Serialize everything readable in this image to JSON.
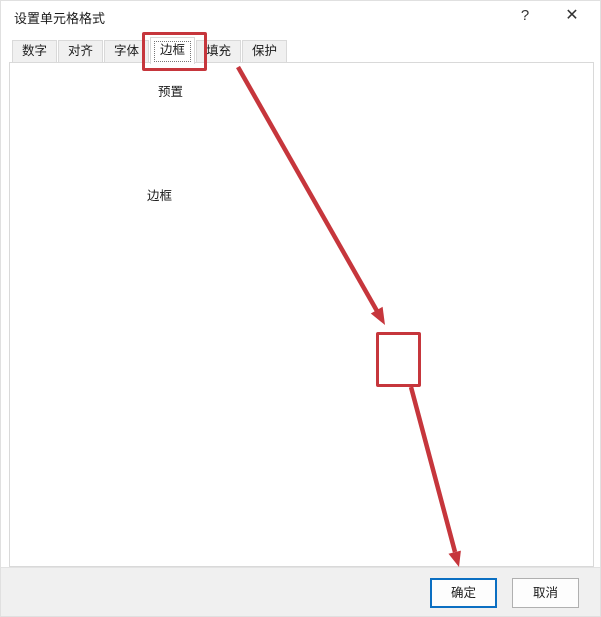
{
  "window": {
    "title": "设置单元格格式",
    "help_glyph": "?",
    "close_glyph": "✕"
  },
  "tabs": [
    {
      "label": "数字"
    },
    {
      "label": "对齐"
    },
    {
      "label": "字体"
    },
    {
      "label": "边框",
      "selected": true
    },
    {
      "label": "填充"
    },
    {
      "label": "保护"
    }
  ],
  "line_group": {
    "title": "直线",
    "style_label": "样式(S):",
    "none_label": "无",
    "styles_left": [
      {
        "pattern": "none"
      },
      {
        "pattern": "dot-fine"
      },
      {
        "pattern": "dot"
      },
      {
        "pattern": "dash-dot-dot"
      },
      {
        "pattern": "dash-dot"
      },
      {
        "pattern": "dash"
      },
      {
        "pattern": "thin",
        "selected": true
      }
    ],
    "styles_right": [
      {
        "pattern": "med-dash-dot-dot"
      },
      {
        "pattern": "slant-dash"
      },
      {
        "pattern": "med-dash-dot"
      },
      {
        "pattern": "med-dash"
      },
      {
        "pattern": "solid-med"
      },
      {
        "pattern": "solid-thick"
      },
      {
        "pattern": "double"
      }
    ],
    "color_label": "颜色(C):",
    "color_value": "自动",
    "chevron_glyph": "˅"
  },
  "presets": {
    "title": "预置",
    "buttons": [
      {
        "label": "无(N)"
      },
      {
        "label": "外边框(O)"
      },
      {
        "label": "内部(I)",
        "disabled": true
      }
    ]
  },
  "border_group": {
    "title": "边框",
    "preview_text": "文本",
    "buttons": {
      "top": {
        "state": "active"
      },
      "middle_h": {
        "state": "disabled"
      },
      "bottom": {
        "state": "active"
      },
      "diag_up": {
        "state": "normal"
      },
      "left": {
        "state": "active"
      },
      "middle_v": {
        "state": "disabled"
      },
      "right": {
        "state": "active"
      },
      "diag_down": {
        "state": "active"
      }
    }
  },
  "hint": "单击预置选项、预览草图及上面的按钮可以添加边框样式。",
  "footer": {
    "ok": "确定",
    "cancel": "取消"
  },
  "colors": {
    "accent": "#0b6fc2",
    "annotation": "#c6363c",
    "toggle-bg": "#cde6f7",
    "toggle-border": "#39708f"
  }
}
